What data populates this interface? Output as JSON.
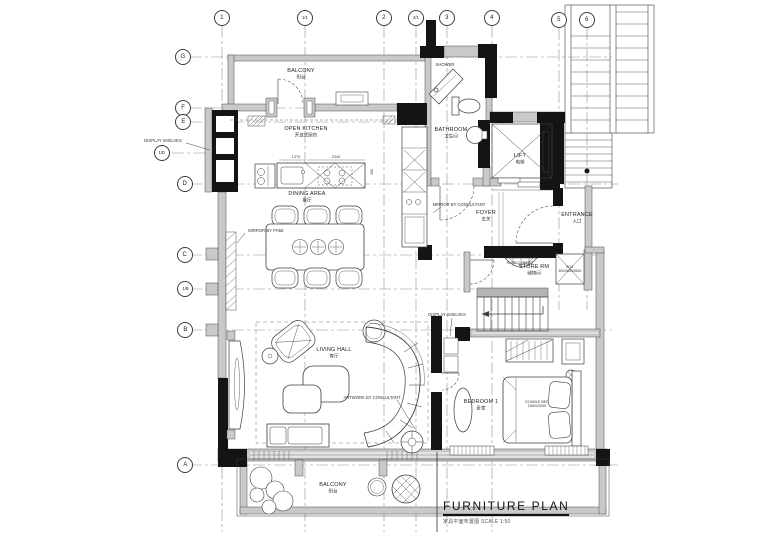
{
  "drawing_title": {
    "main": "FURNITURE PLAN",
    "subtitle": "家具平面布置图  SCALE 1:50"
  },
  "grid": {
    "top": [
      "1",
      "1/1",
      "2",
      "2/1",
      "3",
      "4",
      "5",
      "6"
    ],
    "left": [
      "G",
      "F",
      "E",
      "1/D",
      "D",
      "C",
      "1/B",
      "B",
      "A"
    ]
  },
  "rooms": {
    "balcony_top": {
      "name": "BALCONY",
      "cn": "阳台"
    },
    "open_kitchen": {
      "name": "OPEN KITCHEN",
      "cn": "开放式厨房"
    },
    "shower": {
      "name": "SHOWER"
    },
    "bathroom": {
      "name": "BATHROOM",
      "cn": "卫生间"
    },
    "lift": {
      "name": "LIFT",
      "cn": "电梯"
    },
    "foyer": {
      "name": "FOYER",
      "cn": "玄关"
    },
    "entrance": {
      "name": "ENTRANCE",
      "cn": "入口"
    },
    "store": {
      "name": "STORE RM",
      "cn": "储物间"
    },
    "dining": {
      "name": "DINING AREA",
      "cn": "餐厅"
    },
    "living": {
      "name": "LIVING HALL",
      "cn": "客厅"
    },
    "bedroom1": {
      "name": "BEDROOM 1",
      "cn": "卧室"
    },
    "balcony_bottom": {
      "name": "BALCONY",
      "cn": "阳台"
    }
  },
  "furniture": {
    "double_bed": {
      "name": "DOUBLE BED",
      "size": "1500X2000"
    },
    "wm": {
      "name": "W.M.",
      "size": "600X600X600"
    }
  },
  "annotations": {
    "display_shelves_left": "DISPLAY SHELVES",
    "mirror_ffe": "MIRROR BY FF&E",
    "mirror_consultant": "MIRROR BY CONSULTANT",
    "shoe_cabinet": "SHOE CABINET",
    "display_shelves_mid": "DISPLAY SHELVES",
    "artwork": "ARTWORK BY CONSULTANT"
  },
  "dimensions": {
    "kitchen_left": "1375",
    "kitchen_island": "2345",
    "kitchen_depth": "450"
  },
  "colors": {
    "paper": "#ffffff",
    "ink": "#2a2a2a",
    "wall_fill": "#c9c9c9",
    "poche": "#141414",
    "grid_line": "#8f8f8f"
  }
}
